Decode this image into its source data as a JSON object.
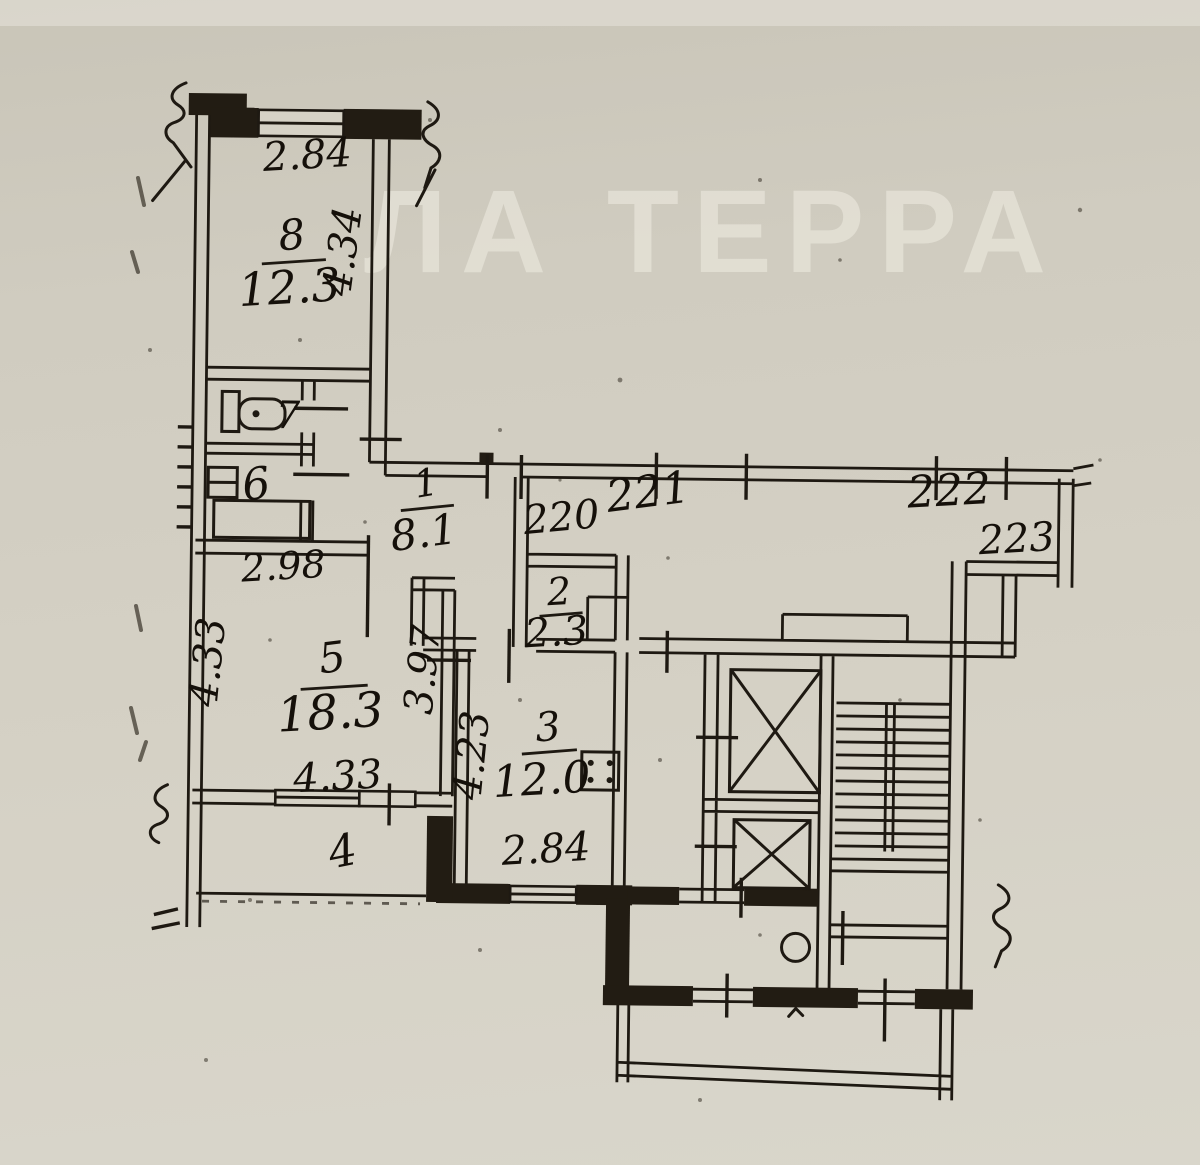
{
  "watermark": "ЛА ТЕРРА",
  "rooms": {
    "r8": {
      "num": "8",
      "area": "12.3"
    },
    "r7": {
      "num": "7"
    },
    "r6": {
      "num": "6"
    },
    "r1": {
      "num": "1",
      "area": "8.1"
    },
    "r2": {
      "num": "2",
      "area": "2.3"
    },
    "r3": {
      "num": "3",
      "area": "12.0"
    },
    "r5": {
      "num": "5",
      "area": "18.3"
    },
    "r4": {
      "num": "4"
    }
  },
  "dimensions": {
    "room8_top": "2.84",
    "room8_side": "4.34",
    "room5_top": "2.98",
    "room5_left": "4.33",
    "room5_right": "3.97",
    "room5_bottom": "4.33",
    "room3_left": "4.23",
    "room3_bottom": "2.84"
  },
  "corridor_doors": {
    "d220": "220",
    "d221": "221",
    "d222": "222",
    "d223": "223"
  }
}
